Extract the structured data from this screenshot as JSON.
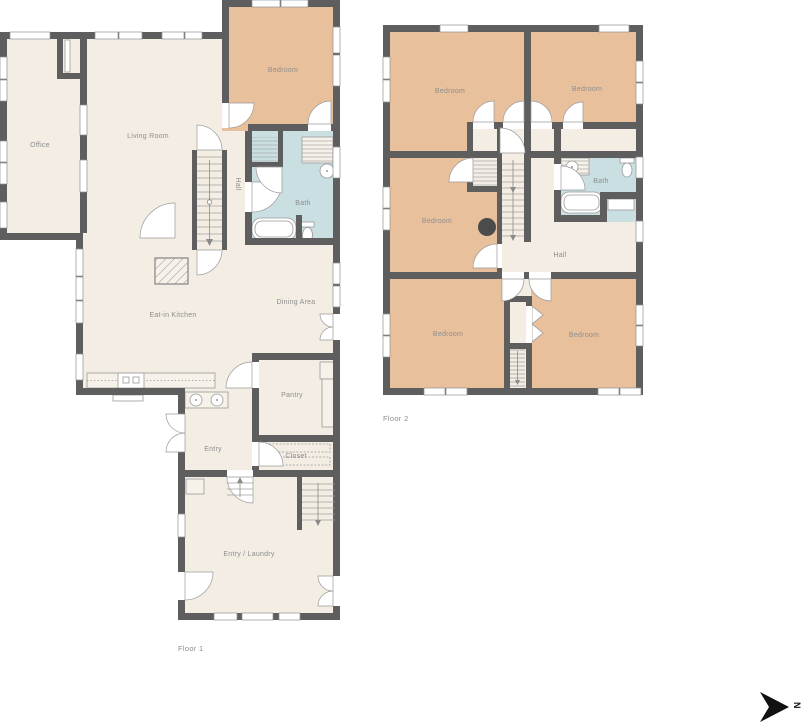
{
  "colors": {
    "wall": "#5e5e5e",
    "floor": "#f3ede4",
    "bedroom": "#e9c09c",
    "bath": "#c9dfe2",
    "chimney": "#4b4b4b",
    "compass": "#111111"
  },
  "floor1": {
    "label": "Floor 1",
    "rooms": {
      "office": "Office",
      "living_room": "Living Room",
      "bedroom": "Bedroom",
      "hall": "Hall",
      "bath": "Bath",
      "kitchen": "Eat-in Kitchen",
      "dining": "Dining Area",
      "pantry": "Pantry",
      "entry": "Entry",
      "closet": "Closet",
      "entry_laundry": "Entry / Laundry"
    }
  },
  "floor2": {
    "label": "Floor 2",
    "rooms": {
      "bedroom_top_left": "Bedroom",
      "bedroom_top_right": "Bedroom",
      "bedroom_mid_left": "Bedroom",
      "bath": "Bath",
      "hall": "Hall",
      "bedroom_bottom_left": "Bedroom",
      "bedroom_bottom_right": "Bedroom"
    }
  },
  "compass": {
    "north_label": "N"
  }
}
